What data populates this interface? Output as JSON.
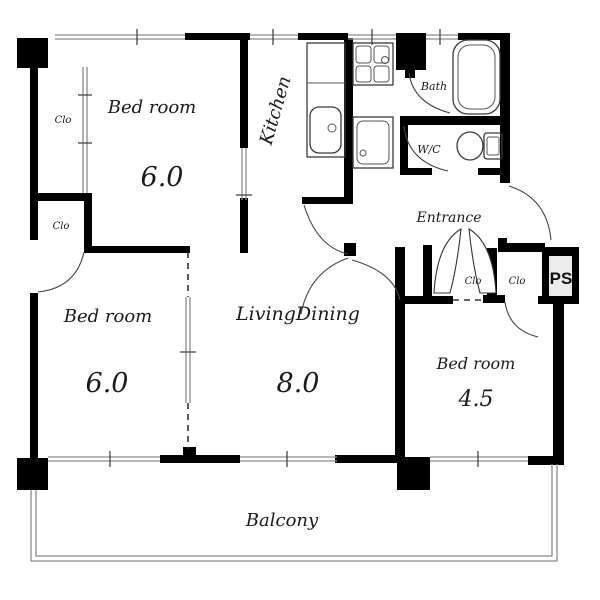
{
  "floorplan": {
    "rooms": {
      "bedroom_nw": {
        "label": "Bed room",
        "size": "6.0"
      },
      "bedroom_w": {
        "label": "Bed room",
        "size": "6.0"
      },
      "bedroom_e": {
        "label": "Bed room",
        "size": "4.5"
      },
      "living_dining": {
        "label": "LivingDining",
        "size": "8.0"
      },
      "kitchen": {
        "label": "Kitchen"
      },
      "bath": {
        "label": "Bath"
      },
      "wc": {
        "label": "W/C"
      },
      "entrance": {
        "label": "Entrance"
      },
      "balcony": {
        "label": "Balcony"
      },
      "closet_nw_upper": {
        "label": "Clo"
      },
      "closet_nw_lower": {
        "label": "Clo"
      },
      "closet_hall_left": {
        "label": "Clo"
      },
      "closet_hall_right": {
        "label": "Clo"
      },
      "pipe_space": {
        "label": "PS"
      }
    },
    "colors": {
      "wall": "#000000",
      "fixture_line": "#3a3a3a",
      "window_line": "#8a8a8a",
      "ps_fill": "#ececec",
      "background": "#ffffff"
    }
  }
}
